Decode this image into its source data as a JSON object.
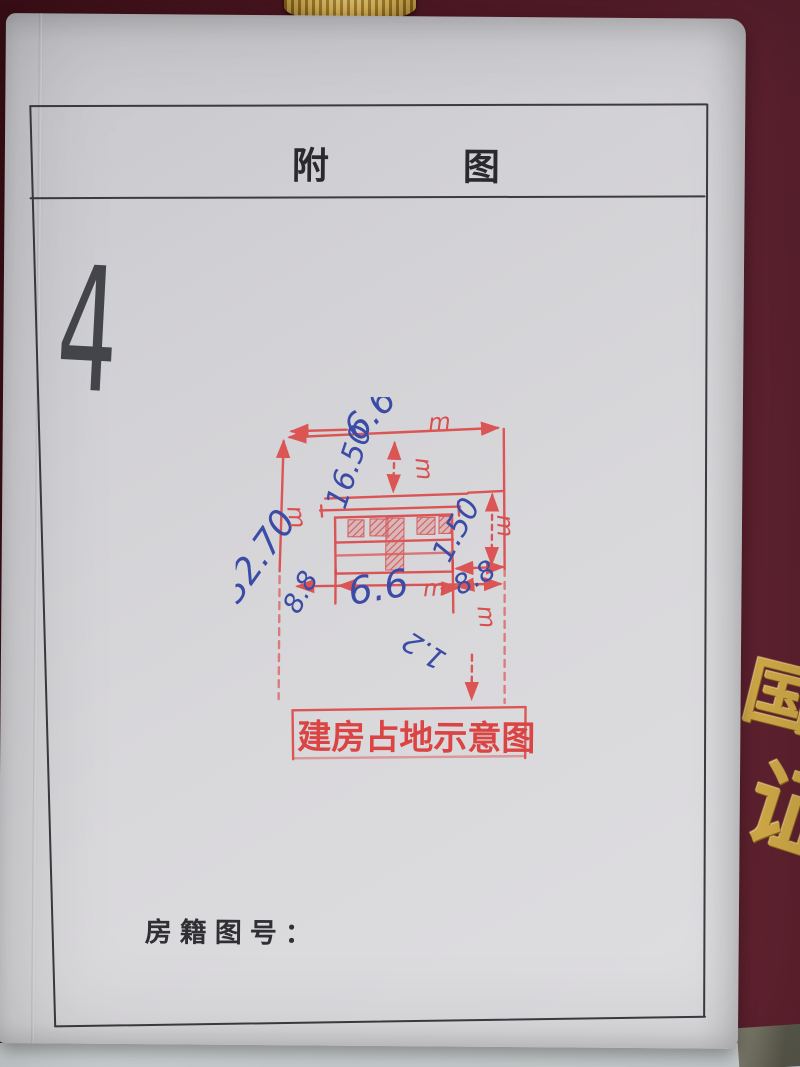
{
  "document": {
    "header_title": "附图",
    "page_number": "4",
    "footer_label": "房籍图号："
  },
  "stamp": {
    "title": "建房占地示意图",
    "unit": "m",
    "ink_color": "#dc4747",
    "dimensions": {
      "top_width": "6.6",
      "front_setback": "16.50",
      "left_depth": "32.70",
      "left_gap": "8.8",
      "house_width": "6.6",
      "right_gap": "8.8",
      "right_height": "1.50",
      "note": "1.2"
    }
  },
  "handwriting": {
    "pen_color": "#3a4ca6",
    "pencil_color": "#45454c"
  },
  "book_cover": {
    "color": "#5e2130",
    "gold_color": "#d7ae4a",
    "embossed_upper": "国",
    "embossed_lower": "证"
  }
}
